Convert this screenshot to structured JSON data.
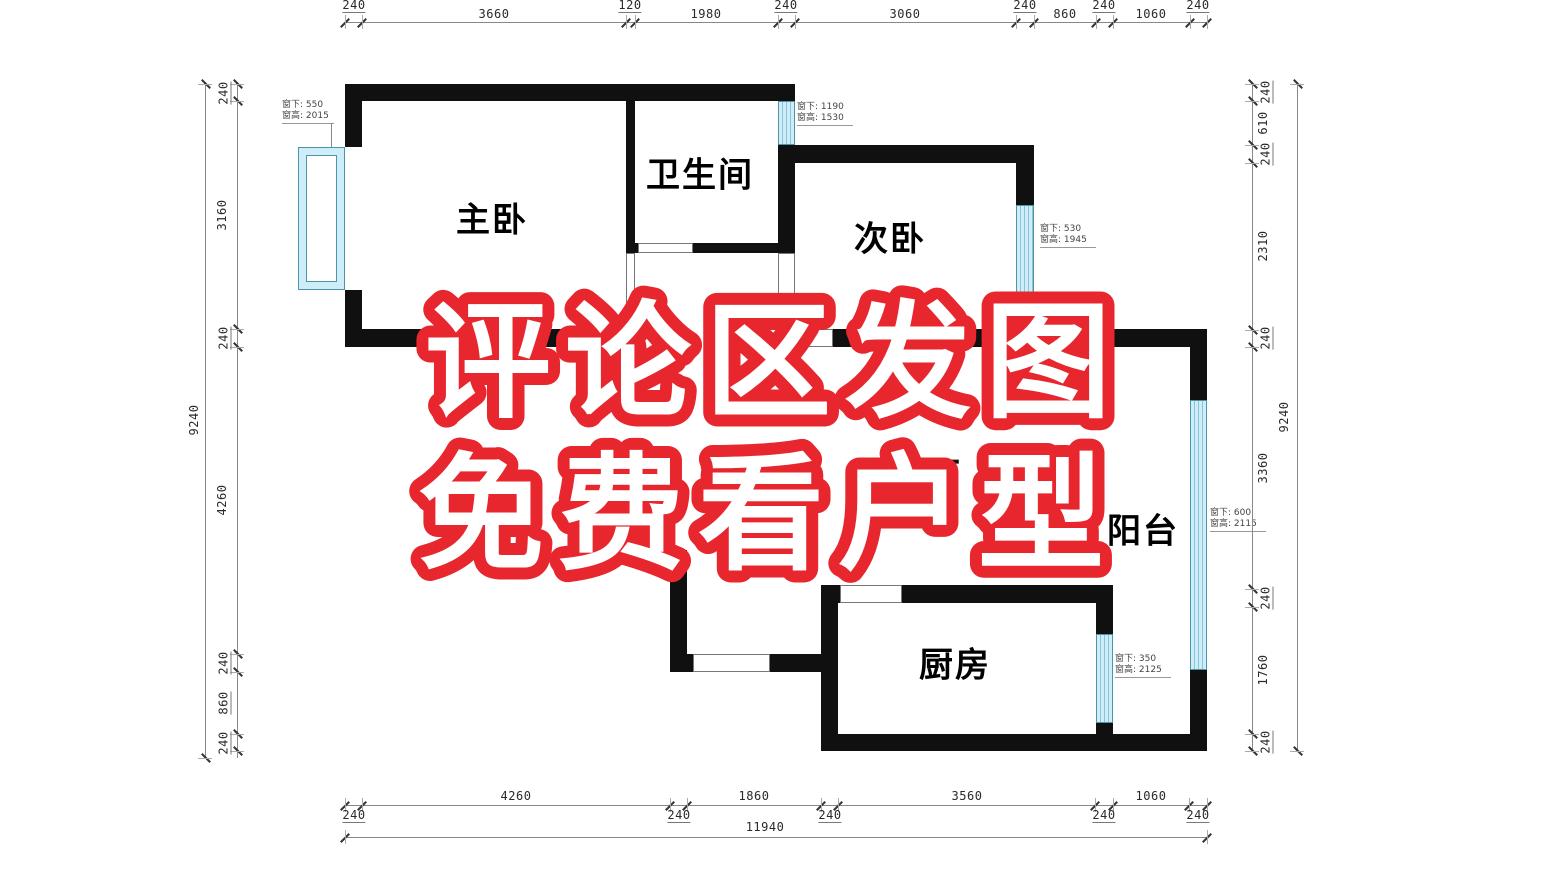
{
  "overlay": {
    "line1": "评论区发图",
    "line2": "免费看户型",
    "stroke_color": "#e8262e",
    "fill_color": "#ffffff"
  },
  "rooms": {
    "master": "主卧",
    "bathroom": "卫生间",
    "second_bedroom": "次卧",
    "balcony": "阳台",
    "kitchen": "厨房",
    "living_fragment": "厅"
  },
  "window_notes": {
    "master": {
      "sill": "窗下: 550",
      "height": "窗高: 2015"
    },
    "bathroom": {
      "sill": "窗下: 1190",
      "height": "窗高: 1530"
    },
    "second": {
      "sill": "窗下: 530",
      "height": "窗高: 1945"
    },
    "balcony": {
      "sill": "窗下: 600",
      "height": "窗高: 2115"
    },
    "kitchen": {
      "sill": "窗下: 350",
      "height": "窗高: 2125"
    }
  },
  "dimensions": {
    "top": [
      "240",
      "3660",
      "120",
      "1980",
      "240",
      "3060",
      "240",
      "860",
      "240",
      "1060",
      "240"
    ],
    "bottom": [
      "240",
      "4260",
      "240",
      "1860",
      "240",
      "3560",
      "240",
      "1060",
      "240"
    ],
    "bottom_total": "11940",
    "left": [
      "240",
      "3160",
      "240",
      "4260",
      "240",
      "860",
      "240"
    ],
    "left_total": "9240",
    "right": [
      "240",
      "610",
      "240",
      "2310",
      "240",
      "3360",
      "240",
      "1760",
      "240"
    ],
    "right_total": "9240"
  },
  "colors": {
    "wall": "#101010",
    "window_fill": "#cdeef8",
    "overlay_red": "#e8262e"
  }
}
